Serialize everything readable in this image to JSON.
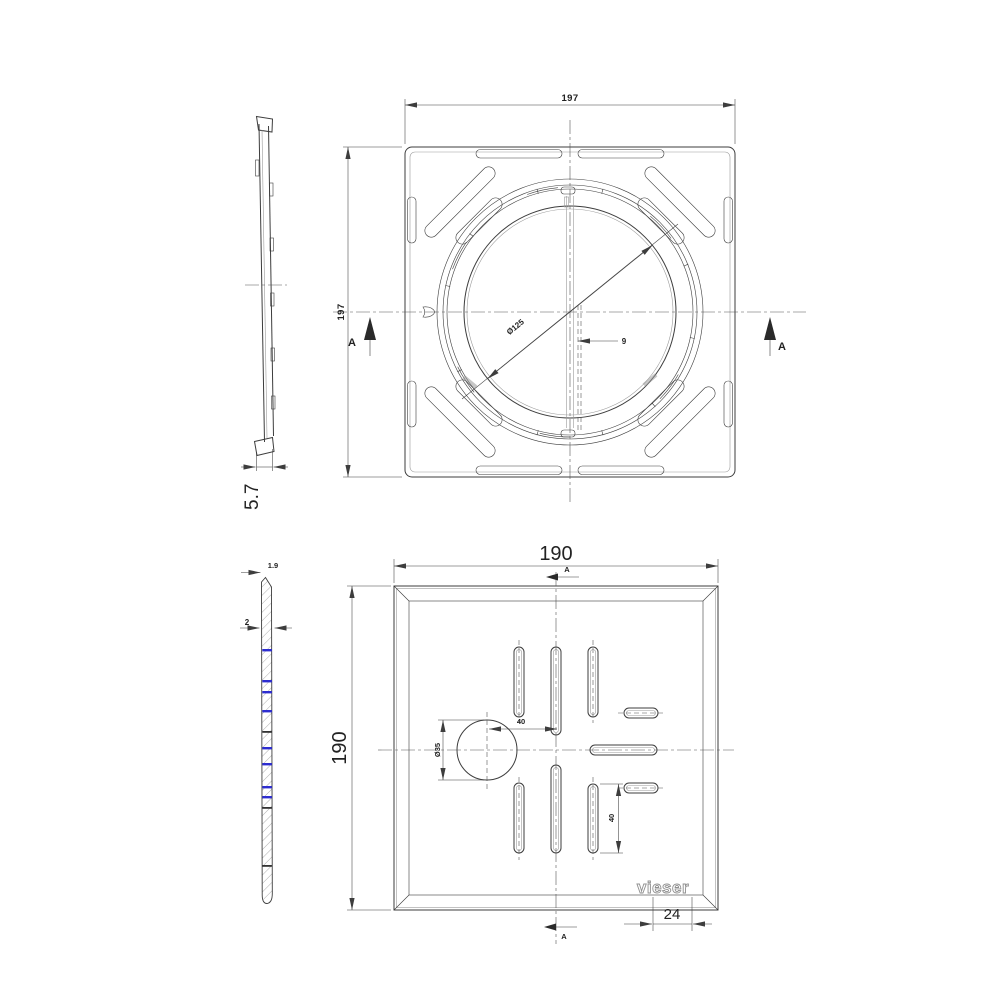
{
  "views": {
    "profile": {
      "overall_thickness": "5.7"
    },
    "top": {
      "width": "197",
      "height": "197",
      "opening_diameter": "Ø125",
      "center_offset": "9",
      "section_label": "A"
    },
    "section": {
      "tip_thickness": "1.9",
      "material_thickness": "2"
    },
    "bottom": {
      "width": "190",
      "height": "190",
      "hole_diameter": "Ø35",
      "hole_center_offset": "40",
      "slot_length": "40",
      "logo_margin": "24",
      "logo_text": "vieser",
      "section_label": "A"
    }
  },
  "colors": {
    "line": "#3d3d3d",
    "light_line": "#9a9a9a",
    "accent_blue": "#2d2dd0",
    "background": "#ffffff"
  }
}
